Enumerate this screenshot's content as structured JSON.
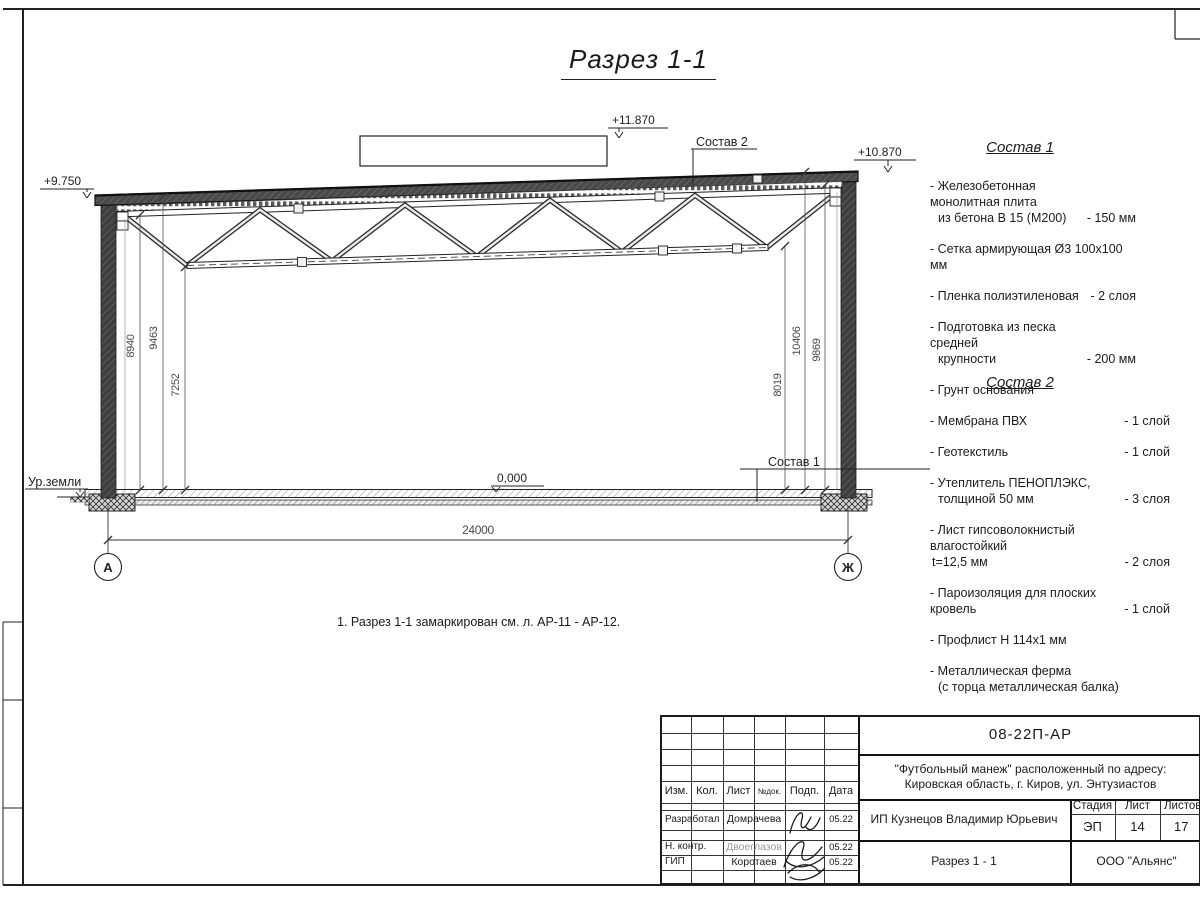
{
  "colors": {
    "ink": "#1a1a1a",
    "muted": "#4a4a4a"
  },
  "drawing": {
    "title": "Разрез 1-1",
    "elevations": {
      "parapet": "+11.870",
      "roof_right": "+10.870",
      "roof_left": "+9.750",
      "floor": "0,000"
    },
    "labels": {
      "ground": "Ур.земли",
      "leader_roof": "Состав 2",
      "leader_floor": "Состав 1"
    },
    "dims": {
      "span": "24000",
      "left": [
        "8940",
        "9463",
        "7252"
      ],
      "right": [
        "8019",
        "10406",
        "9869"
      ]
    },
    "axes": {
      "left": "А",
      "right": "Ж"
    },
    "note": "1. Разрез 1-1 замаркирован см. л. АР-11 - АР-12."
  },
  "spec1": {
    "heading": "Состав 1",
    "items": [
      {
        "l1": "- Железобетонная  монолитная плита",
        "l2": "из бетона В 15 (М200)",
        "val": "- 150 мм"
      },
      {
        "l1": "- Сетка армирующая Ø3 100х100 мм",
        "val": ""
      },
      {
        "l1": "- Пленка полиэтиленовая",
        "val": "- 2 слоя"
      },
      {
        "l1": "- Подготовка из песка средней",
        "l2": "крупности",
        "val": "- 200 мм"
      },
      {
        "l1": "- Грунт основания",
        "val": ""
      }
    ]
  },
  "spec2": {
    "heading": "Состав 2",
    "items": [
      {
        "l1": "- Мембрана ПВХ",
        "val": "- 1 слой"
      },
      {
        "l1": "- Геотекстиль",
        "val": "- 1 слой"
      },
      {
        "l1": "- Утеплитель ПЕНОПЛЭКС,",
        "l2": "толщиной 50 мм",
        "val": "- 3 слоя"
      },
      {
        "l1": "- Лист гипсоволокнистый влагостойкий",
        "l2": "t=12,5 мм",
        "val": "- 2 слоя"
      },
      {
        "l1": "- Пароизоляция для плоских кровель",
        "val": "- 1 слой"
      },
      {
        "l1": "- Профлист Н 114х1 мм",
        "val": ""
      },
      {
        "l1": "- Металлическая ферма",
        "l2": "(с торца металлическая балка)",
        "val": ""
      }
    ]
  },
  "titleblock": {
    "doc_number": "08-22П-АР",
    "project_line1": "\"Футбольный манеж\" расположенный по адресу:",
    "project_line2": "Кировская область, г. Киров, ул. Энтузиастов",
    "client": "ИП Кузнецов Владимир Юрьевич",
    "sheet_title": "Разрез 1 - 1",
    "company": "ООО \"Альянс\"",
    "headers": {
      "izm": "Изм.",
      "kol": "Кол.",
      "list": "Лист",
      "ndok": "№док.",
      "podp": "Подп.",
      "data": "Дата",
      "stage": "Стадия",
      "sheet": "Лист",
      "sheets": "Листов"
    },
    "stage": "ЭП",
    "sheet_no": "14",
    "sheets_total": "17",
    "rows": [
      {
        "role": "Разработал",
        "name": "Домрачева",
        "date": "05.22"
      },
      {
        "role": "Н. контр.",
        "name": "Двоеглазов",
        "date": "05.22"
      },
      {
        "role": "ГИП",
        "name": "Коротаев",
        "date": "05.22"
      }
    ]
  }
}
